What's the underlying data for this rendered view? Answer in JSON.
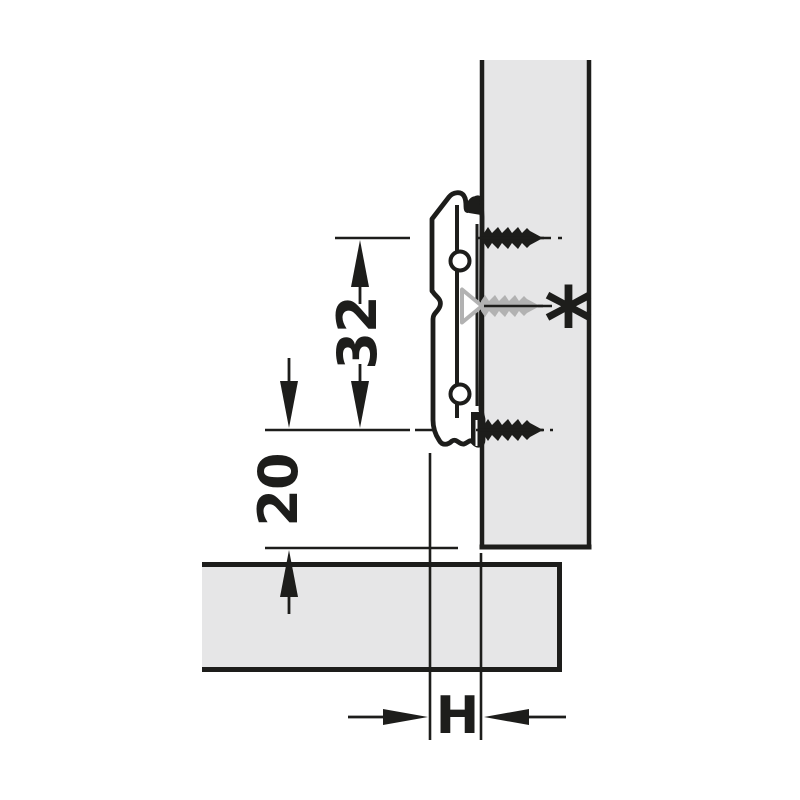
{
  "diagram": {
    "type": "technical-installation-drawing",
    "subject": "Cross mounting plate screwed to cabinet side panel, side view with drilling dimensions",
    "labels": {
      "hole_spacing": "32",
      "edge_distance": "20",
      "mounting_height": "H",
      "alternative_marker": "*"
    },
    "colors": {
      "background": "#ffffff",
      "line": "#1d1d1b",
      "panel_fill": "#e6e6e7",
      "plate_fill": "#ffffff",
      "alt_screw": "#b2b2b2"
    }
  }
}
